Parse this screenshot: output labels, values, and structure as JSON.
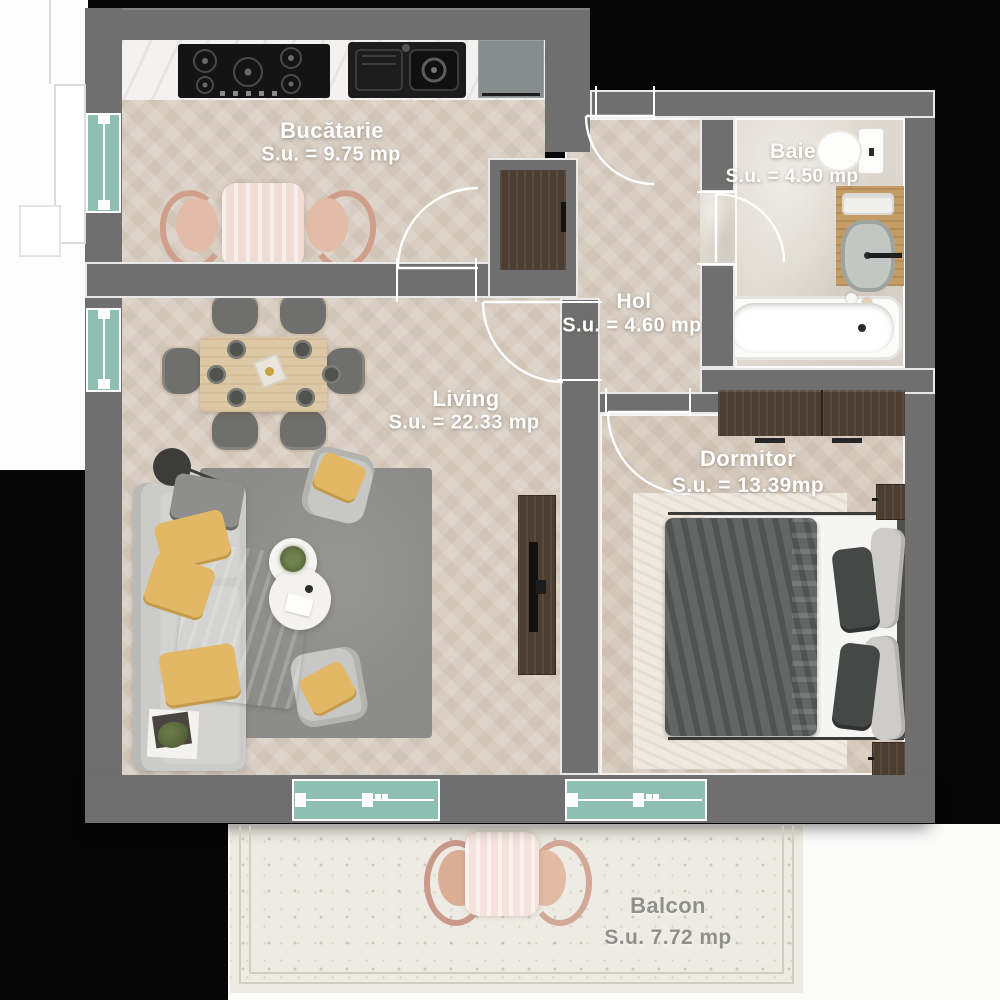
{
  "plan_title": "Apartment floor plan",
  "rooms": [
    {
      "id": "bucatarie",
      "name": "Bucătarie",
      "area": "S.u. = 9.75 mp"
    },
    {
      "id": "baie",
      "name": "Baie",
      "area": "S.u. = 4.50 mp"
    },
    {
      "id": "hol",
      "name": "Hol",
      "area": "S.u. = 4.60 mp"
    },
    {
      "id": "living",
      "name": "Living",
      "area": "S.u. = 22.33 mp"
    },
    {
      "id": "dormitor",
      "name": "Dormitor",
      "area": "S.u. = 13.39mp"
    },
    {
      "id": "balcon",
      "name": "Balcon",
      "area": "S.u. 7.72 mp"
    }
  ],
  "colors": {
    "wall": "#6f6f6f",
    "window_teal": "#8fbfb2",
    "floor_wood": "#d7ccc0",
    "floor_bath": "#ded8cf",
    "floor_balcony": "#edebe3",
    "label_white": "#ffffff",
    "label_gray": "#8f8f8c",
    "furniture_wood_dark": "#4c3d31",
    "accent_pillow_yellow": "#e2b765"
  }
}
